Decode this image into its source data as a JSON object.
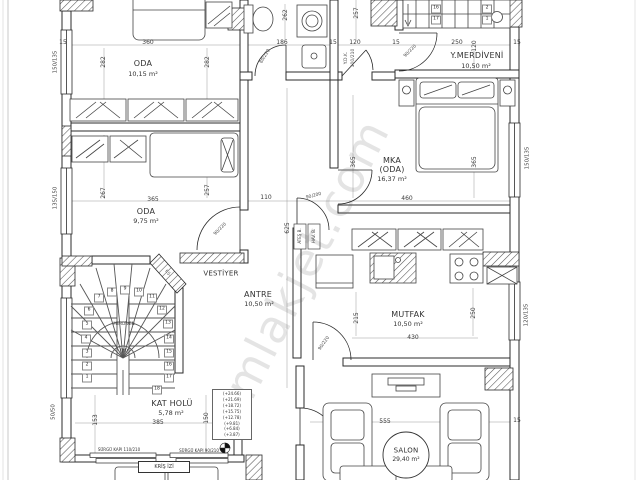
{
  "watermark": "emlakjet.com",
  "rooms": {
    "oda1": {
      "name": "ODA",
      "area": "10,15 m²"
    },
    "y_merdiveni": {
      "name": "Y.MERDİVENİ",
      "area": "10,50 m²"
    },
    "mka": {
      "name": "MKA",
      "sub": "(ODA)",
      "area": "16,37 m²"
    },
    "oda2": {
      "name": "ODA",
      "area": "9,75 m²"
    },
    "vestiyer": {
      "name": "VESTİYER"
    },
    "antre": {
      "name": "ANTRE",
      "area": "10,50 m²"
    },
    "mutfak": {
      "name": "MUTFAK",
      "area": "10,50 m²"
    },
    "kat_holu": {
      "name": "KAT HOLÜ",
      "area": "5,78 m²"
    },
    "salon": {
      "name": "SALON",
      "area": "29,40 m²"
    },
    "merdiven": {
      "name": "MERDİVEN",
      "mark": "(M)"
    }
  },
  "dims": [
    "360",
    "282",
    "282",
    "15",
    "186",
    "15",
    "120",
    "15",
    "250",
    "120",
    "15",
    "262",
    "257",
    "267",
    "365",
    "257",
    "110",
    "460",
    "365",
    "365",
    "625",
    "215",
    "250",
    "430",
    "153",
    "385",
    "150",
    "555",
    "15"
  ],
  "windows": [
    "150/135",
    "135/150",
    "50/50",
    "150/135",
    "120/135"
  ],
  "doors": {
    "bath": "80/220",
    "ydk1": "Y.D.K.",
    "ydk2": "100/210",
    "stairwell": "90/220",
    "oda2": "90/220",
    "kitchen_entry": "90/200",
    "kitchen_salon": "90/220",
    "sliding1": "SÜRGÜ KAPI 110/210",
    "sliding2": "SÜRGÜ KAPI 90/210"
  },
  "stairs": {
    "upper": [
      "16",
      "17",
      "2",
      "1"
    ],
    "main": [
      "1",
      "2",
      "3",
      "4",
      "5",
      "6",
      "7",
      "8",
      "9",
      "10",
      "11",
      "12",
      "13",
      "14",
      "15",
      "16",
      "17",
      "18"
    ]
  },
  "elevations": [
    "(+24.66)",
    "(+21.69)",
    "(+18.72)",
    "(+15.75)",
    "(+12.78)",
    "(+9.81)",
    "(+6.84)",
    "(+3.87)"
  ],
  "shafts": {
    "s1": "ATEŞ B.",
    "s2": "HAV. B.",
    "fs": "F.Ş."
  },
  "notes": {
    "beam": "KRİŞ İZİ"
  }
}
